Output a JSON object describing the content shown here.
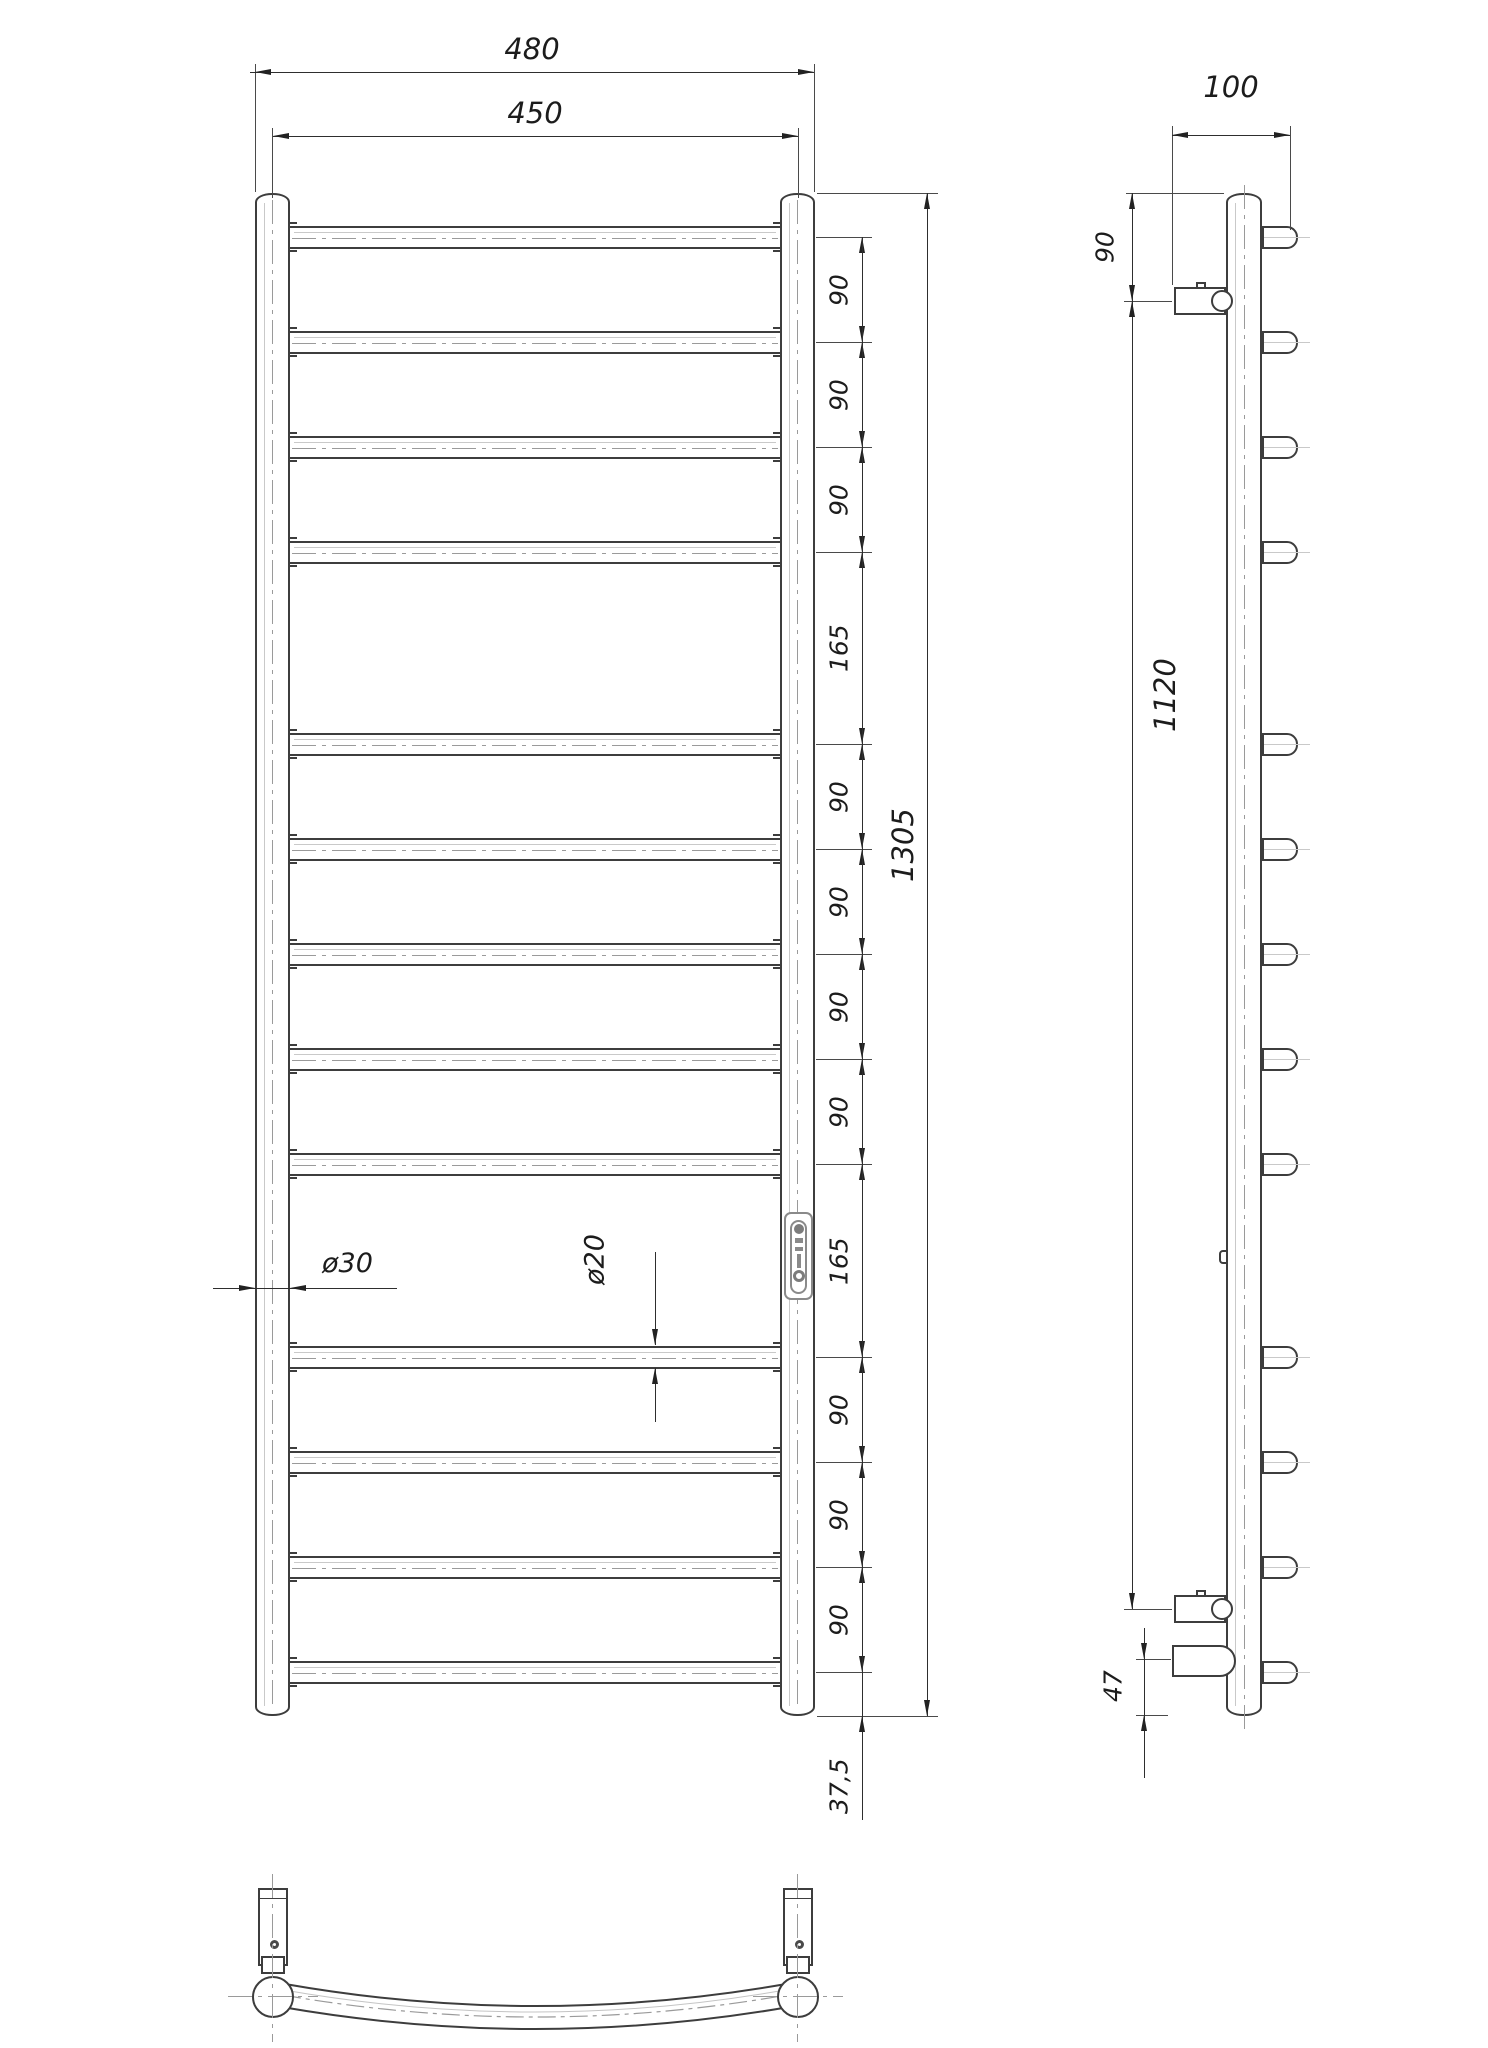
{
  "front_view": {
    "dim_width_overall": "480",
    "dim_width_axes": "450",
    "dim_height_overall": "1305",
    "dim_chain": [
      "90",
      "90",
      "90",
      "165",
      "90",
      "90",
      "90",
      "90",
      "165",
      "90",
      "90",
      "90"
    ],
    "dim_bottom_offset": "37,5",
    "dim_post_diameter": "ø30",
    "dim_tube_diameter": "ø20"
  },
  "side_view": {
    "dim_depth": "100",
    "dim_top_to_bracket": "90",
    "dim_bracket_span": "1120",
    "dim_outlet_to_bottom": "47"
  }
}
